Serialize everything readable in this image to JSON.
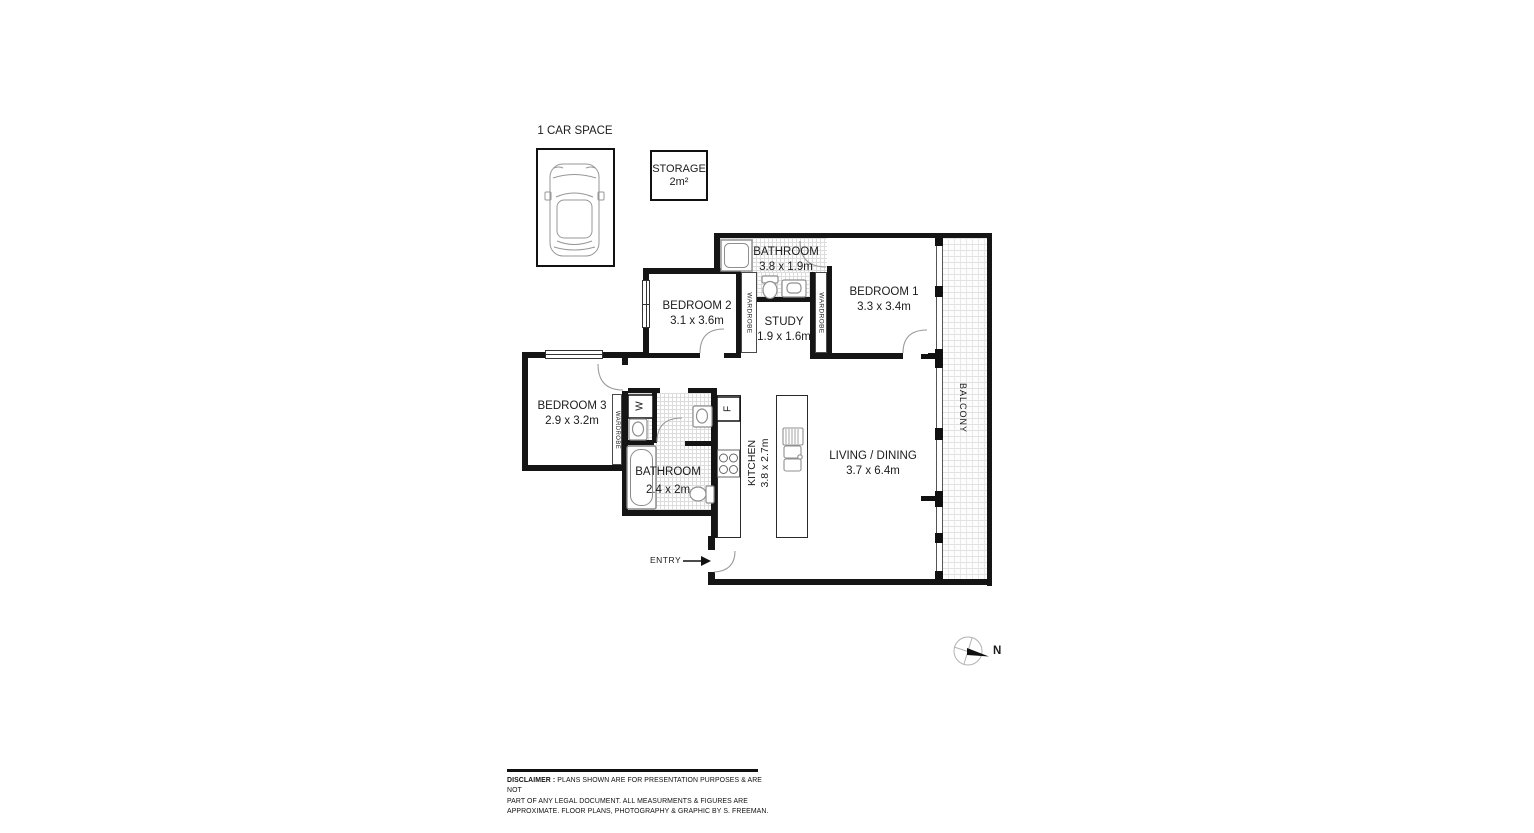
{
  "plan": {
    "car_space": {
      "label": "1 CAR SPACE"
    },
    "storage": {
      "label": "STORAGE",
      "area": "2m²"
    },
    "rooms": {
      "bathroom_main": {
        "name": "BATHROOM",
        "dims": "3.8 x 1.9m"
      },
      "bedroom1": {
        "name": "BEDROOM 1",
        "dims": "3.3 x 3.4m"
      },
      "bedroom2": {
        "name": "BEDROOM 2",
        "dims": "3.1 x 3.6m"
      },
      "bedroom3": {
        "name": "BEDROOM 3",
        "dims": "2.9 x 3.2m"
      },
      "study": {
        "name": "STUDY",
        "dims": "1.9 x 1.6m"
      },
      "bathroom2": {
        "name": "BATHROOM",
        "dims": "2.4 x 2m"
      },
      "kitchen": {
        "name": "KITCHEN",
        "dims": "3.8 x 2.7m"
      },
      "living": {
        "name": "LIVING / DINING",
        "dims": "3.7 x 6.4m"
      },
      "balcony": {
        "name": "BALCONY"
      }
    },
    "labels": {
      "wardrobe": "WARDROBE",
      "washer": "W",
      "fridge": "F",
      "entry": "ENTRY",
      "north": "N"
    },
    "disclaimer": {
      "heading": "DISCLAIMER :",
      "line1": " PLANS SHOWN ARE FOR PRESENTATION PURPOSES & ARE NOT",
      "line2": "PART OF ANY LEGAL DOCUMENT. ALL MEASURMENTS & FIGURES ARE",
      "line3": "APPROXIMATE. FLOOR PLANS, PHOTOGRAPHY & GRAPHIC BY  S. FREEMAN."
    },
    "colors": {
      "wall": "#151515",
      "tile": "#dcdcdc",
      "fixture": "#8f8f8f"
    }
  }
}
